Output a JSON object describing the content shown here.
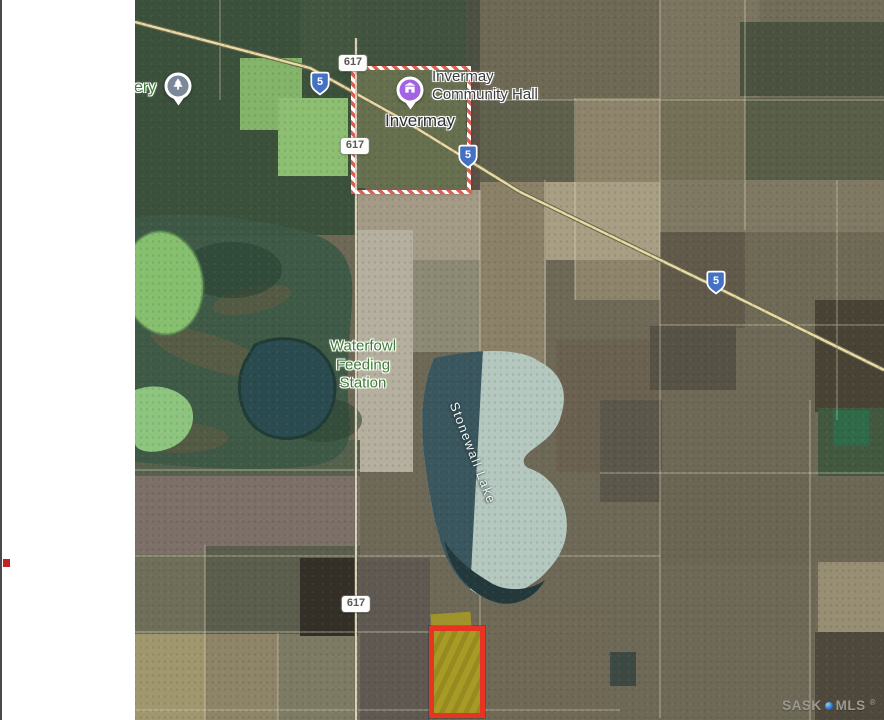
{
  "window": {
    "left_margin_marker_color": "#c1251f"
  },
  "map": {
    "partial_poi_label": "ery",
    "town_label": "Invermay",
    "hall": {
      "line1": "Invermay",
      "line2": "Community Hall"
    },
    "waterfowl": {
      "line1": "Waterfowl",
      "line2": "Feeding",
      "line3": "Station"
    },
    "lake_label": "Stonewall Lake",
    "road_badges": [
      "617",
      "617",
      "617"
    ],
    "highway_shields": [
      "5",
      "5",
      "5"
    ],
    "watermark": {
      "sask": "SASK",
      "mls": "MLS",
      "reg": "®"
    },
    "colors": {
      "highlight_red": "#e73322",
      "highlight_fill": "#a89b25",
      "town_boundary": "#dd5f51",
      "shield_blue": "#4471c4",
      "hall_pin_purple": "#a263e4",
      "poi_pin_gray": "#7b8898",
      "park_label_green": "#3f7d35",
      "water_dark": "#3a565e",
      "water_light": "#b4c8c0"
    }
  }
}
